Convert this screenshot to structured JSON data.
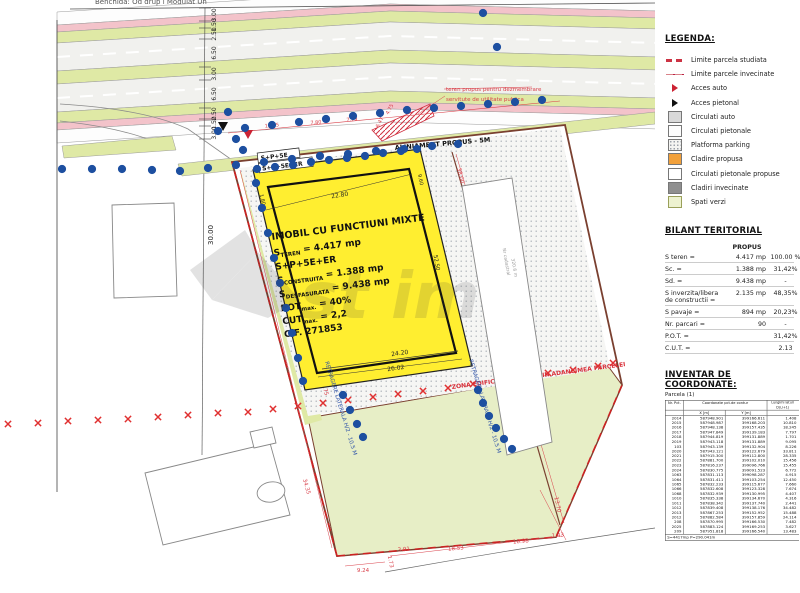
{
  "drawing": {
    "sheet_title": "Benchida: Od drup i Modulat Un",
    "road": {
      "dim_labels": [
        "3.00",
        "1.50",
        "2.50",
        "6.50",
        "3.00",
        "6.50",
        "2.50",
        "1.50",
        "3.00"
      ],
      "dim_total": "30.00",
      "frontage_dims": [
        "12.95",
        "7.80",
        "7.79",
        "6.47",
        "4.75"
      ],
      "aliniament_label": "ALINIAMENT PROPUS - 5M",
      "note_line1": "teren propus pentru dezmembrare",
      "note_line2": "servitute de utilitate publica"
    },
    "zona_label": "ZONA EDIFICABILA - 65% DIN ADANCIMEA PARCELEI",
    "retragere_left": "RETRAGERE LATERALA H/2 - 10.5 M",
    "retragere_right": "RETRAGERE LATERALA H/2 - 10.5 M",
    "building": {
      "tag_small": "S+P+5E",
      "tag_small2": "S+P+5E+ER",
      "title": "IMOBIL CU FUNCTIUNI MIXTE",
      "l2a": "S",
      "l2sub": "TEREN",
      "l2b": " = 4.417 mp",
      "l3": "S+P+5E+ER",
      "l4a": "S",
      "l4sub": "CONSTRUITA",
      "l4b": " = 1.388 mp",
      "l5a": "S",
      "l5sub": "DESFASURATA",
      "l5b": " = 9.438 mp",
      "l6a": "POT",
      "l6sub": "max.",
      "l6b": " = 40%",
      "l7a": "CUT",
      "l7sub": "max.",
      "l7b": " = 2,2",
      "l8": "C.F. 271853",
      "dim_top": "22.80",
      "dim_left": "1.80",
      "dim_right_top": "9.60",
      "dim_right": "52.50",
      "dim_bottom1": "24.20",
      "dim_bottom2": "26.02"
    },
    "boundary_dims": {
      "left1": "18.70",
      "left2": "28.75",
      "bl": "34.35",
      "right1": "38.00",
      "right2": "35.70",
      "b1": "9.24",
      "b2": "18.53",
      "b3": "10.98",
      "b4": "1.43",
      "b5": "13.70",
      "b6": "1.73",
      "b7": "3.91"
    },
    "neighbor_note1": "Nr cadastral",
    "neighbor_note2": "320.6 m"
  },
  "legend": {
    "title": "LEGENDA:",
    "items": [
      {
        "type": "sw-dashred",
        "label": "Limite parcela studiata"
      },
      {
        "type": "sw-linered",
        "label": "Limite parcele invecinate"
      },
      {
        "type": "sw-arrow-red",
        "label": "Acces auto"
      },
      {
        "type": "sw-arrow-black",
        "label": "Acces pietonal"
      },
      {
        "type": "sw-box sw-gray",
        "label": "Circulati auto"
      },
      {
        "type": "sw-box sw-white",
        "label": "Circulati pietonale"
      },
      {
        "type": "sw-box sw-stipple",
        "label": "Platforma parking"
      },
      {
        "type": "sw-box sw-orange",
        "label": "Cladire propusa"
      },
      {
        "type": "sw-box sw-white2",
        "label": "Circulati pietonale propuse"
      },
      {
        "type": "sw-box sw-darkgray",
        "label": "Cladiri invecinate"
      },
      {
        "type": "sw-box sw-green",
        "label": "Spati verzi"
      }
    ]
  },
  "bilant": {
    "title": "BILANT TERITORIAL",
    "col_header": "PROPUS",
    "rows": [
      {
        "l": "S teren =",
        "v1": "4.417 mp",
        "v2": "100.00 %"
      },
      {
        "l": "Sc.          =",
        "v1": "1.388 mp",
        "v2": "31,42%"
      },
      {
        "l": "Sd.          =",
        "v1": "9.438 mp",
        "v2": "-"
      },
      {
        "l": "S inverzita/libera de constructii =",
        "v1": "2.135 mp",
        "v2": "48,35%"
      },
      {
        "l": "S pavaje   =",
        "v1": "894 mp",
        "v2": "20,23%"
      },
      {
        "l": "Nr. parcari =",
        "v1": "90",
        "v2": "-"
      },
      {
        "l": "P.O.T.      =",
        "v1": "",
        "v2": "31,42%"
      },
      {
        "l": "C.U.T.      =",
        "v1": "",
        "v2": "2.13"
      }
    ]
  },
  "coords": {
    "title": "INVENTAR DE COORDONATE:",
    "subtitle": "Parcela (1)",
    "col_nr": "Nr. Pct.",
    "col_group": "Coordonate pct.de contur",
    "col_x": "X [m]",
    "col_y": "Y [m]",
    "col_d": "Lungimi laturi D(i,i+1)",
    "rows": [
      [
        "2014",
        "587948.901",
        "399166.611",
        "1.408"
      ],
      [
        "2015",
        "587948.987",
        "399168.203",
        "10.810"
      ],
      [
        "2016",
        "587948.138",
        "399157.435",
        "18.245"
      ],
      [
        "2017",
        "587947.849",
        "399139.183",
        "7.797"
      ],
      [
        "2018",
        "587944.819",
        "399131.889",
        "1.701"
      ],
      [
        "2019",
        "587943.118",
        "399131.889",
        "9.095"
      ],
      [
        "103",
        "587943.139",
        "399132.904",
        "8.226"
      ],
      [
        "2020",
        "587943.121",
        "399122.679",
        "33.811"
      ],
      [
        "2021",
        "587915.300",
        "399112.800",
        "28.335"
      ],
      [
        "2022",
        "587881.700",
        "399102.010",
        "15.456"
      ],
      [
        "2023",
        "587816.237",
        "399096.766",
        "15.455"
      ],
      [
        "2024",
        "587830.775",
        "399091.523",
        "6.772"
      ],
      [
        "1063",
        "587831.113",
        "399098.287",
        "4.915"
      ],
      [
        "1064",
        "587831.411",
        "399103.254",
        "12.450"
      ],
      [
        "1065",
        "587832.233",
        "399115.677",
        "7.660"
      ],
      [
        "1066",
        "587832.608",
        "399123.328",
        "7.674"
      ],
      [
        "1068",
        "587832.939",
        "399130.995",
        "4.407"
      ],
      [
        "1010",
        "587835.338",
        "399134.670",
        "4.316"
      ],
      [
        "1011",
        "587838.342",
        "399137.740",
        "2.441"
      ],
      [
        "1012",
        "587839.408",
        "399138.176",
        "34.482"
      ],
      [
        "2013",
        "587867.253",
        "399152.952",
        "15.488"
      ],
      [
        "2012",
        "587882.584",
        "399157.859",
        "24.114"
      ],
      [
        "208",
        "587870.995",
        "399166.530",
        "7.482"
      ],
      [
        "2025",
        "587883.124",
        "399169.253",
        "3.627"
      ],
      [
        "209",
        "587951.818",
        "399166.540",
        "13.483"
      ]
    ],
    "footer": "S=4417mp   P=290.041m"
  }
}
